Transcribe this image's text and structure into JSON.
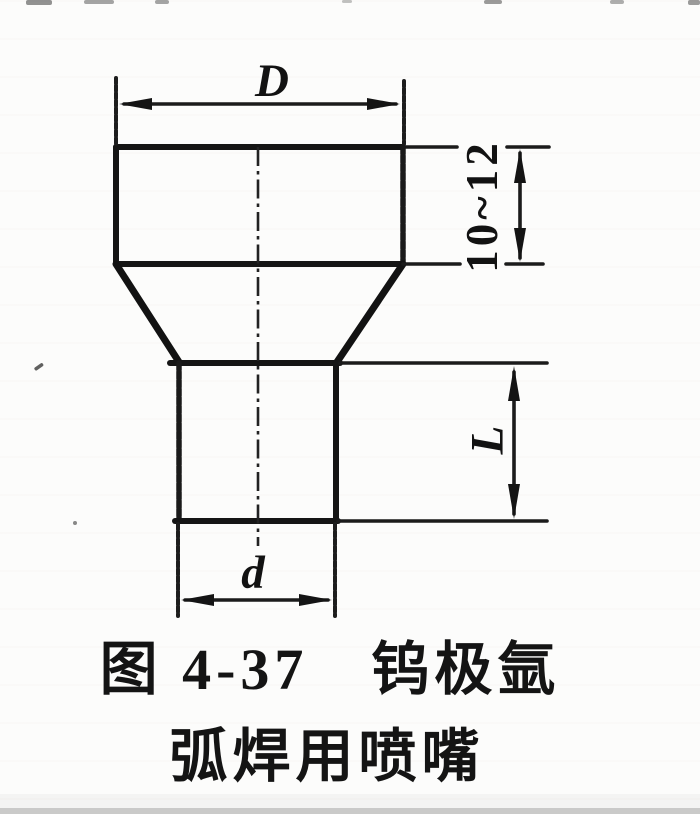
{
  "figure": {
    "type": "technical-drawing",
    "subject": "welding-nozzle-cross-section",
    "ink_color": "#151515",
    "paper_color": "#fcfcfb",
    "dimension_labels": {
      "top_outer_diameter": "D",
      "upper_body_height_range": "10~12",
      "lower_body_length": "L",
      "bottom_inner_diameter": "d"
    },
    "caption": {
      "line1": "图 4-37　钨极氩",
      "line2": "弧焊用喷嘴"
    }
  }
}
